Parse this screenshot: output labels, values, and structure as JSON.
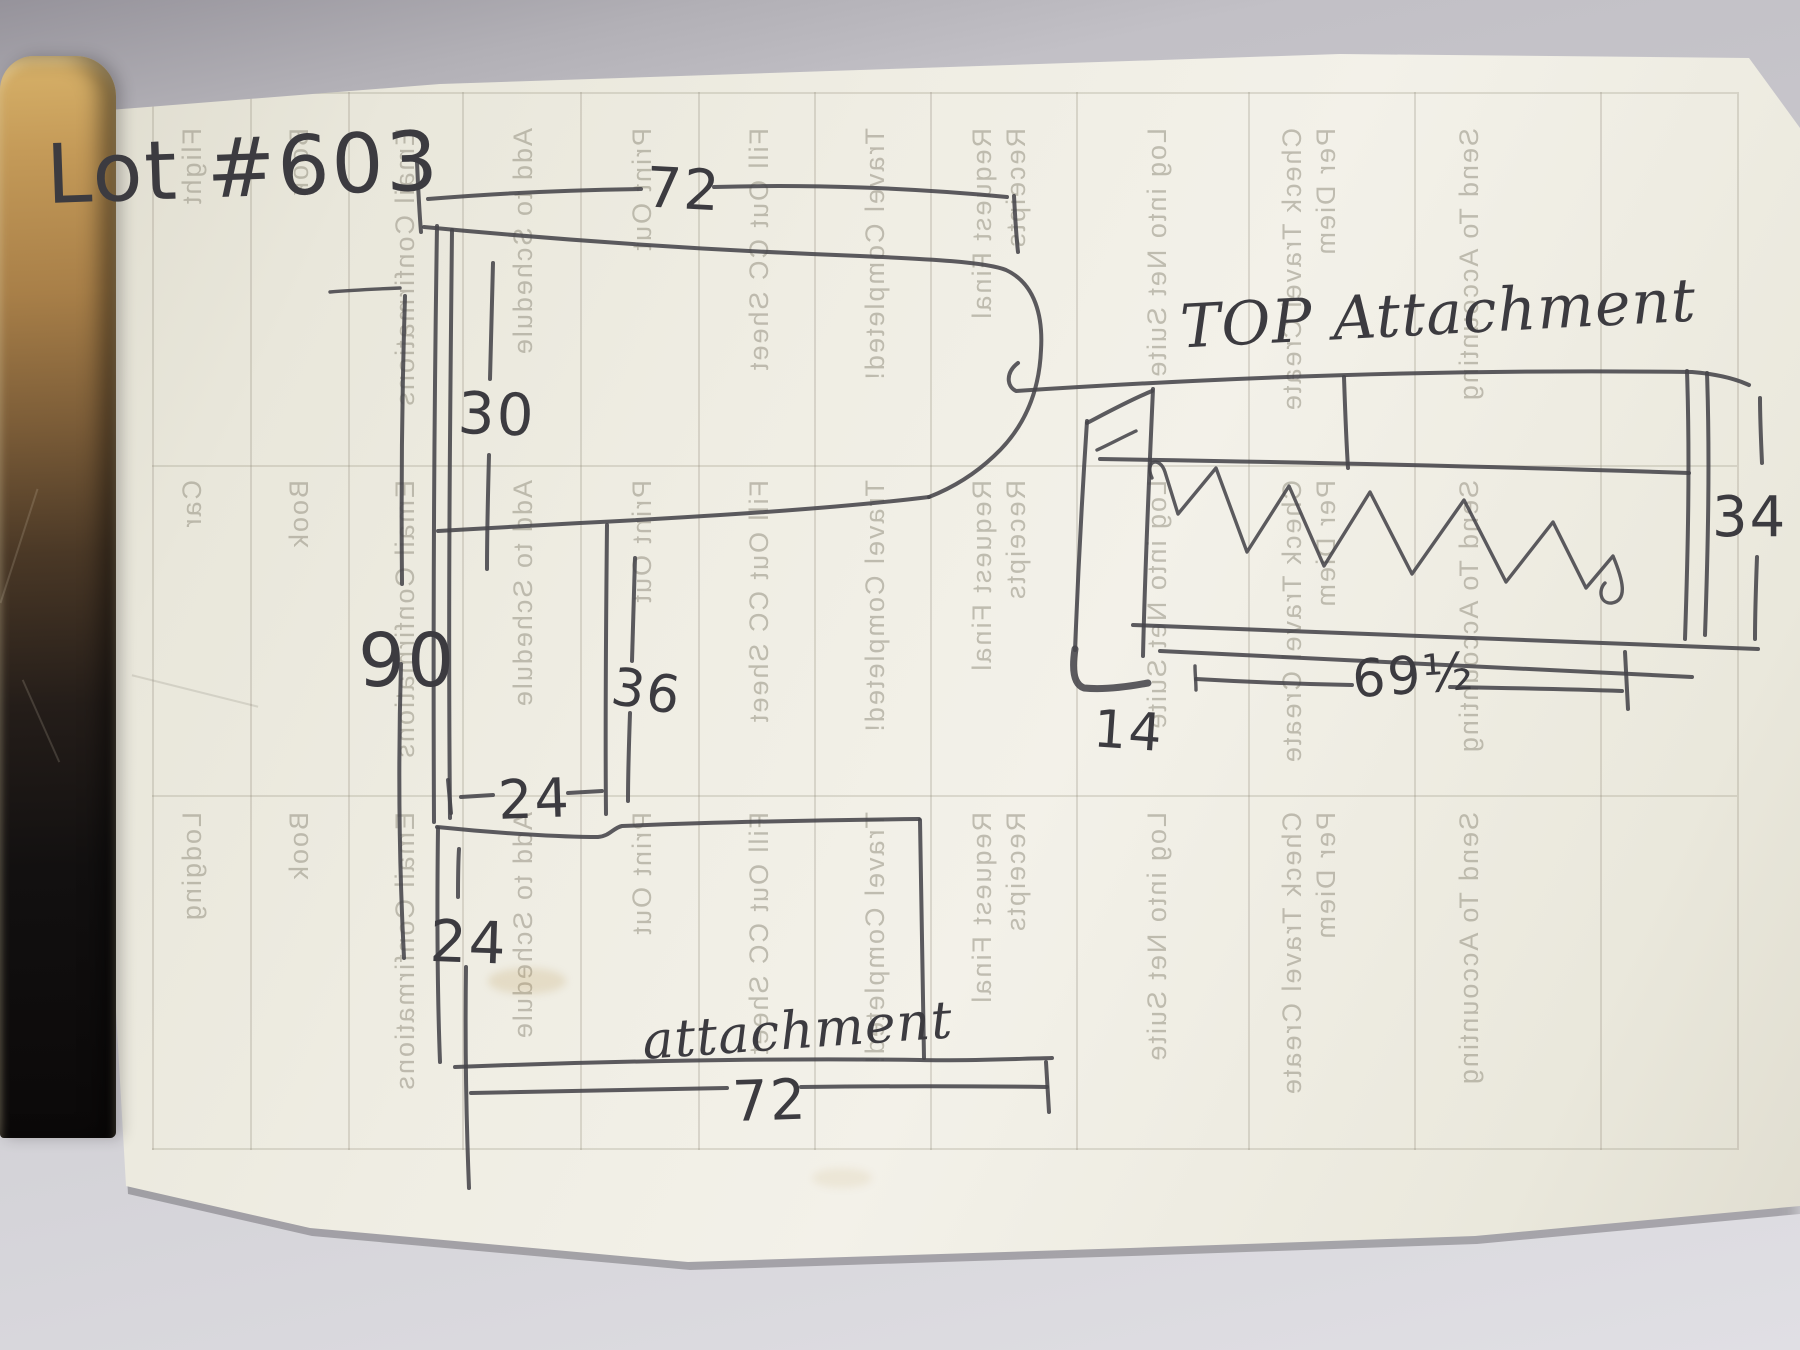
{
  "annotations": {
    "lot_number": "Lot #603",
    "left_figure": {
      "top_width": "72",
      "upper_section_height": "30",
      "overall_height": "90",
      "middle_section_height": "36",
      "middle_section_width": "24",
      "lower_section_offset": "24",
      "label": "attachment",
      "bottom_width": "72"
    },
    "right_figure": {
      "title": "TOP Attachment",
      "end_height": "34",
      "inner_width": "69½",
      "foot_depth": "14"
    }
  },
  "ghost_table": {
    "row_labels": [
      "Flight",
      "Car",
      "Lodging"
    ],
    "book_label": "Book",
    "columns": [
      "Email Confirmations",
      "Add to Schedule",
      "Print Out",
      "Fill Out CC Sheet",
      "Travel Completed!",
      "Request Final Receipts",
      "Log into Net Suite",
      "Check Travel Create Per Diem",
      "Send To Accounting"
    ]
  },
  "colors": {
    "paper": "#f0eee4",
    "background": "#bab8be",
    "ink": "#3c3b40",
    "ghost_print": "#a9a598",
    "clipboard_gold": "#c9a258",
    "clipboard_dark": "#0f0d0d"
  }
}
